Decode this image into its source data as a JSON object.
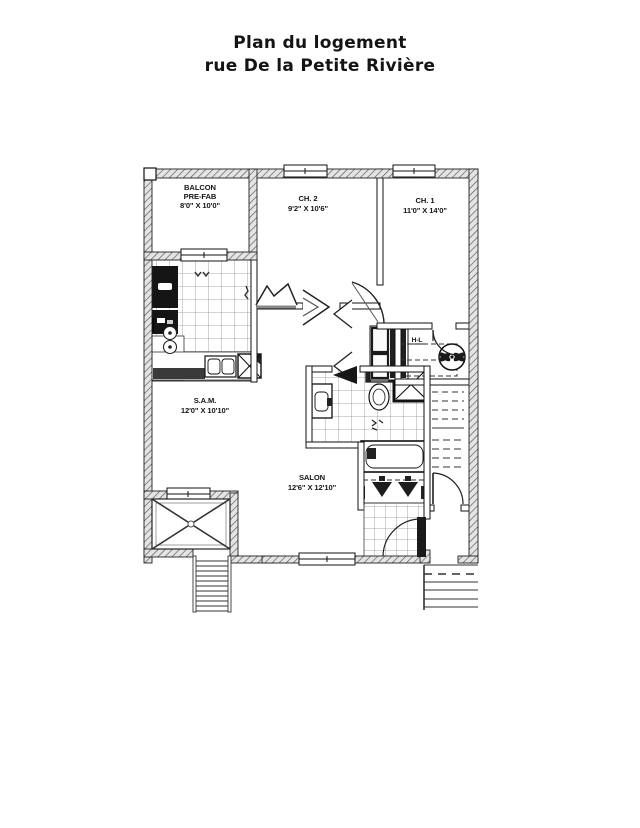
{
  "title": {
    "line1": "Plan du logement",
    "line2": "rue De la Petite Rivière"
  },
  "rooms": {
    "balcon": {
      "name": "BALCON",
      "type_line": "PRE-FAB",
      "dims": "8'0\" X 10'0\""
    },
    "ch2": {
      "name": "CH. 2",
      "dims": "9'2\" X 10'6\""
    },
    "ch1": {
      "name": "CH. 1",
      "dims": "11'0\" X 14'0\""
    },
    "sam": {
      "name": "S.A.M.",
      "dims": "12'0\" X 10'10\""
    },
    "salon": {
      "name": "SALON",
      "dims": "12'6\" X 12'10\""
    },
    "water_heater": {
      "name": "H-L"
    }
  },
  "colors": {
    "ink": "#151515",
    "wall_hatch_bg": "#e4e4e4",
    "dark_fixture": "#1a1a1a"
  }
}
